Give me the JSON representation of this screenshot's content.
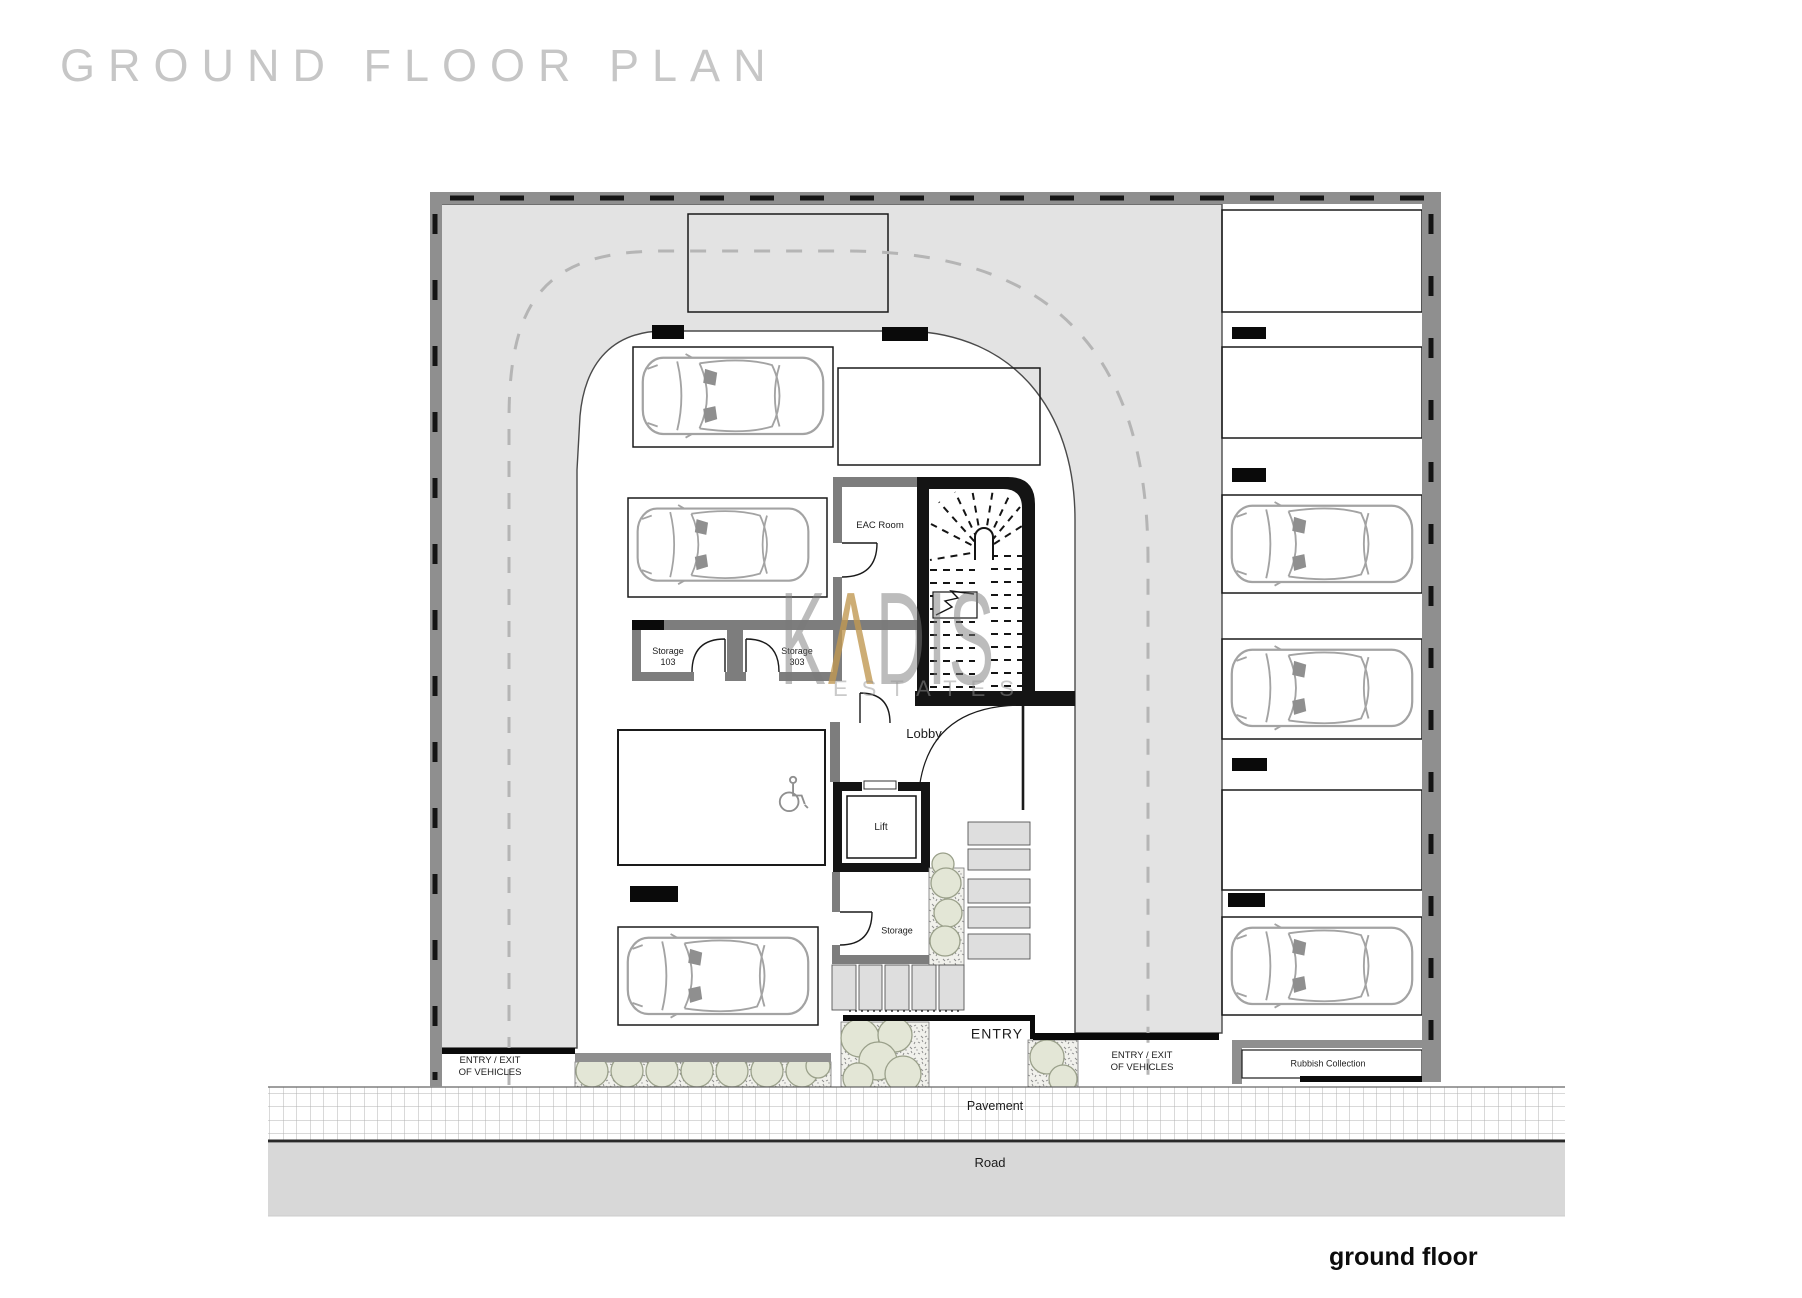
{
  "title": "GROUND FLOOR PLAN",
  "floor_label": "ground floor",
  "watermark": {
    "prefix": "K",
    "accent": "Λ",
    "suffix": "DIS",
    "subtitle": "ESTATES"
  },
  "rooms": {
    "eac": "EAC Room",
    "storage_103": {
      "name": "Storage",
      "number": "103"
    },
    "storage_303": {
      "name": "Storage",
      "number": "303"
    },
    "lobby": "Lobby",
    "lift": "Lift",
    "storage_small": "Storage",
    "rubbish": "Rubbish Collection"
  },
  "site": {
    "entry": "ENTRY",
    "vehicle_entry_left": {
      "line1": "ENTRY / EXIT",
      "line2": "OF VEHICLES"
    },
    "vehicle_entry_right": {
      "line1": "ENTRY / EXIT",
      "line2": "OF VEHICLES"
    },
    "pavement": "Pavement",
    "road": "Road"
  },
  "colors": {
    "driveway": "#e3e3e3",
    "walls": "#8f8f8f",
    "core_walls": "#141414",
    "road": "#d8d8d8",
    "steps": "#dedede",
    "foliage": "#e3e6d6",
    "foliage_edge": "#9aa08a",
    "watermark_gray": "#7a7a7a",
    "watermark_accent": "#c89852",
    "title_gray": "#c6c6c6"
  },
  "icons": [
    "car-icon",
    "wheelchair-icon",
    "bush-icon",
    "staircase-icon"
  ]
}
